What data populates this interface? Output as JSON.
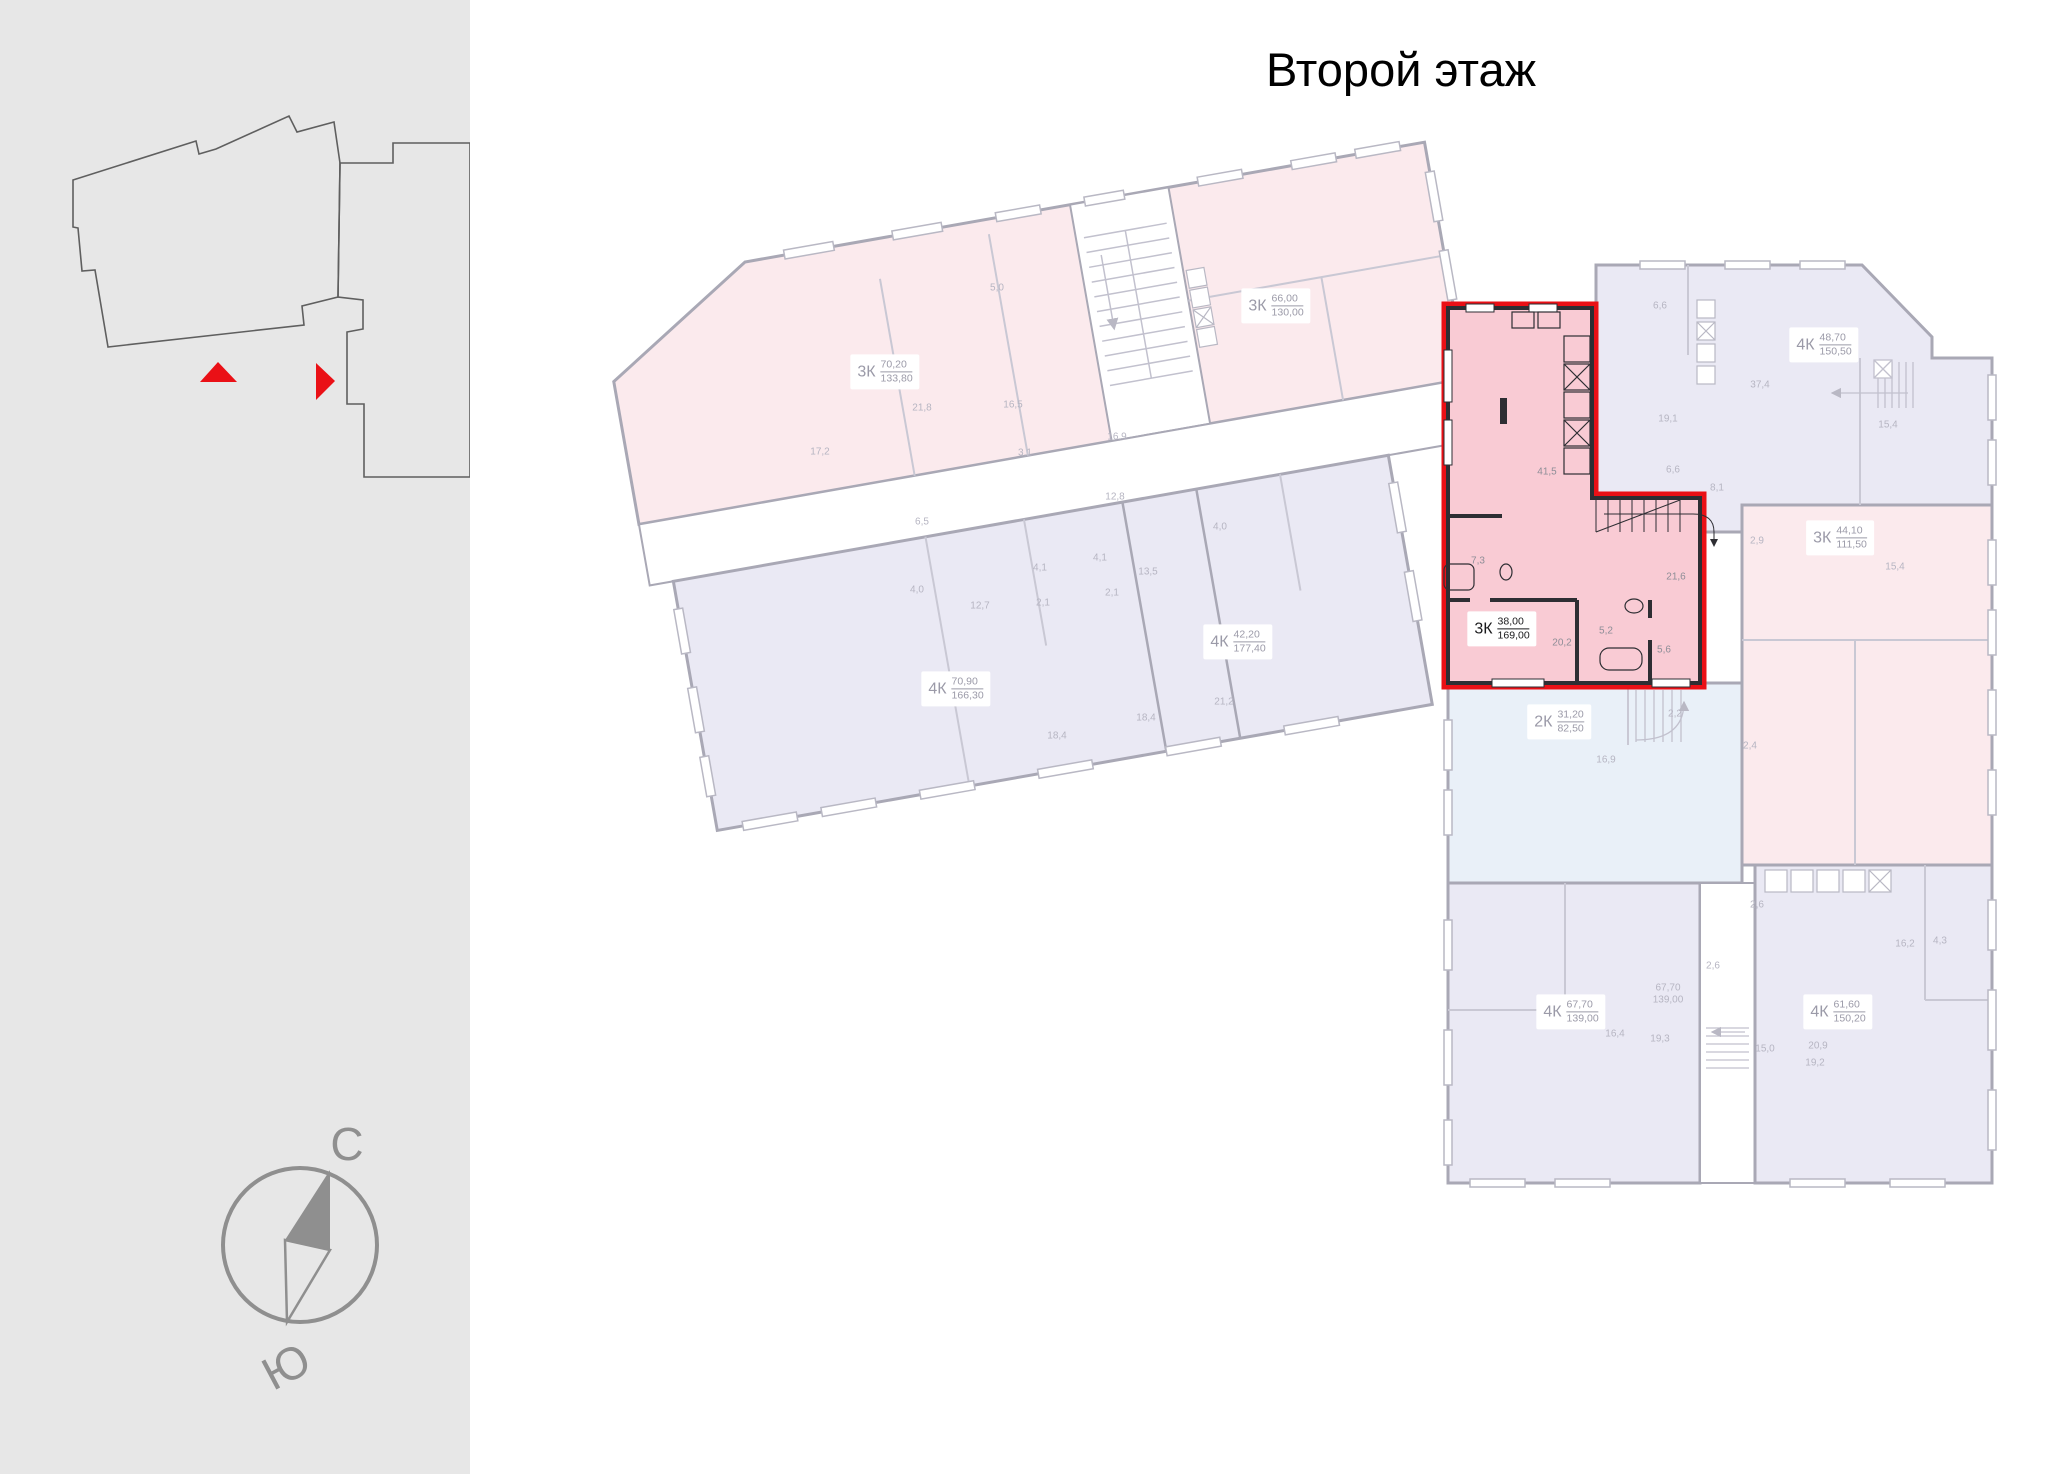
{
  "title": "Второй этаж",
  "compass": {
    "north": "С",
    "south": "Ю"
  },
  "colors": {
    "accent_red": "#ea1016",
    "selected_fill": "#f9cbd4",
    "pink_faded": "#fbeaed",
    "lavender_faded": "#eae9f4",
    "blue_faded": "#e9f0f8",
    "wall_faded": "#a9a8b5",
    "wall_dark": "#2e2e33",
    "sidebar_bg": "#e7e7e7",
    "compass_gray": "#8f8f8f",
    "room_text": "#b6b5c2",
    "chip_text": "#9b9aa8"
  },
  "apartments": [
    {
      "id": "a1",
      "type": "3К",
      "area_top": "70,20",
      "area_bottom": "133,80",
      "x": 885,
      "y": 372,
      "selected": false
    },
    {
      "id": "a2",
      "type": "3К",
      "area_top": "66,00",
      "area_bottom": "130,00",
      "x": 1276,
      "y": 306,
      "selected": false
    },
    {
      "id": "a3",
      "type": "4К",
      "area_top": "70,90",
      "area_bottom": "166,30",
      "x": 956,
      "y": 689,
      "selected": false
    },
    {
      "id": "a4",
      "type": "4К",
      "area_top": "42,20",
      "area_bottom": "177,40",
      "x": 1238,
      "y": 642,
      "selected": false
    },
    {
      "id": "a5",
      "type": "3К",
      "area_top": "38,00",
      "area_bottom": "169,00",
      "x": 1502,
      "y": 629,
      "selected": true
    },
    {
      "id": "a6",
      "type": "4К",
      "area_top": "48,70",
      "area_bottom": "150,50",
      "x": 1824,
      "y": 345,
      "selected": false
    },
    {
      "id": "a7",
      "type": "3К",
      "area_top": "44,10",
      "area_bottom": "111,50",
      "x": 1840,
      "y": 538,
      "selected": false
    },
    {
      "id": "a8",
      "type": "2К",
      "area_top": "31,20",
      "area_bottom": "82,50",
      "x": 1559,
      "y": 722,
      "selected": false
    },
    {
      "id": "a9",
      "type": "4К",
      "area_top": "67,70",
      "area_bottom": "139,00",
      "x": 1571,
      "y": 1012,
      "selected": false
    },
    {
      "id": "a10",
      "type": "4К",
      "area_top": "61,60",
      "area_bottom": "150,20",
      "x": 1838,
      "y": 1012,
      "selected": false
    }
  ],
  "room_labels": [
    {
      "t": "17,2",
      "x": 820,
      "y": 452
    },
    {
      "t": "21,8",
      "x": 922,
      "y": 408
    },
    {
      "t": "16,5",
      "x": 1013,
      "y": 405
    },
    {
      "t": "5,0",
      "x": 997,
      "y": 288
    },
    {
      "t": "3,1",
      "x": 1025,
      "y": 453
    },
    {
      "t": "16,9",
      "x": 1117,
      "y": 437
    },
    {
      "t": "12,8",
      "x": 1115,
      "y": 497
    },
    {
      "t": "6,5",
      "x": 922,
      "y": 522
    },
    {
      "t": "4,0",
      "x": 917,
      "y": 590
    },
    {
      "t": "12,7",
      "x": 980,
      "y": 606
    },
    {
      "t": "2,1",
      "x": 1043,
      "y": 603
    },
    {
      "t": "4,1",
      "x": 1040,
      "y": 568
    },
    {
      "t": "4,1",
      "x": 1100,
      "y": 558
    },
    {
      "t": "13,5",
      "x": 1148,
      "y": 572
    },
    {
      "t": "2,1",
      "x": 1112,
      "y": 593
    },
    {
      "t": "4,0",
      "x": 1220,
      "y": 527
    },
    {
      "t": "18,4",
      "x": 1057,
      "y": 736
    },
    {
      "t": "18,4",
      "x": 1146,
      "y": 718
    },
    {
      "t": "21,2",
      "x": 1224,
      "y": 702
    },
    {
      "t": "6,6",
      "x": 1660,
      "y": 306
    },
    {
      "t": "19,1",
      "x": 1668,
      "y": 419
    },
    {
      "t": "37,4",
      "x": 1760,
      "y": 385
    },
    {
      "t": "15,4",
      "x": 1888,
      "y": 425
    },
    {
      "t": "6,6",
      "x": 1673,
      "y": 470
    },
    {
      "t": "8,1",
      "x": 1717,
      "y": 488
    },
    {
      "t": "2,9",
      "x": 1757,
      "y": 541
    },
    {
      "t": "15,4",
      "x": 1895,
      "y": 567
    },
    {
      "t": "2,2",
      "x": 1675,
      "y": 714
    },
    {
      "t": "16,9",
      "x": 1606,
      "y": 760
    },
    {
      "t": "2,4",
      "x": 1750,
      "y": 746
    },
    {
      "t": "2,6",
      "x": 1757,
      "y": 905
    },
    {
      "t": "2,6",
      "x": 1713,
      "y": 966
    },
    {
      "t": "67,70",
      "x": 1668,
      "y": 988
    },
    {
      "t": "139,00",
      "x": 1668,
      "y": 1000
    },
    {
      "t": "16,2",
      "x": 1905,
      "y": 944
    },
    {
      "t": "4,3",
      "x": 1940,
      "y": 941
    },
    {
      "t": "16,4",
      "x": 1615,
      "y": 1034
    },
    {
      "t": "19,3",
      "x": 1660,
      "y": 1039
    },
    {
      "t": "15,0",
      "x": 1765,
      "y": 1049
    },
    {
      "t": "20,9",
      "x": 1818,
      "y": 1046
    },
    {
      "t": "19,2",
      "x": 1815,
      "y": 1063
    },
    {
      "t": "41,5",
      "x": 1547,
      "y": 472,
      "sel": true
    },
    {
      "t": "7,3",
      "x": 1478,
      "y": 561,
      "sel": true
    },
    {
      "t": "21,6",
      "x": 1676,
      "y": 577,
      "sel": true
    },
    {
      "t": "20,2",
      "x": 1562,
      "y": 643,
      "sel": true
    },
    {
      "t": "5,2",
      "x": 1606,
      "y": 631,
      "sel": true
    },
    {
      "t": "5,6",
      "x": 1664,
      "y": 650,
      "sel": true
    }
  ]
}
